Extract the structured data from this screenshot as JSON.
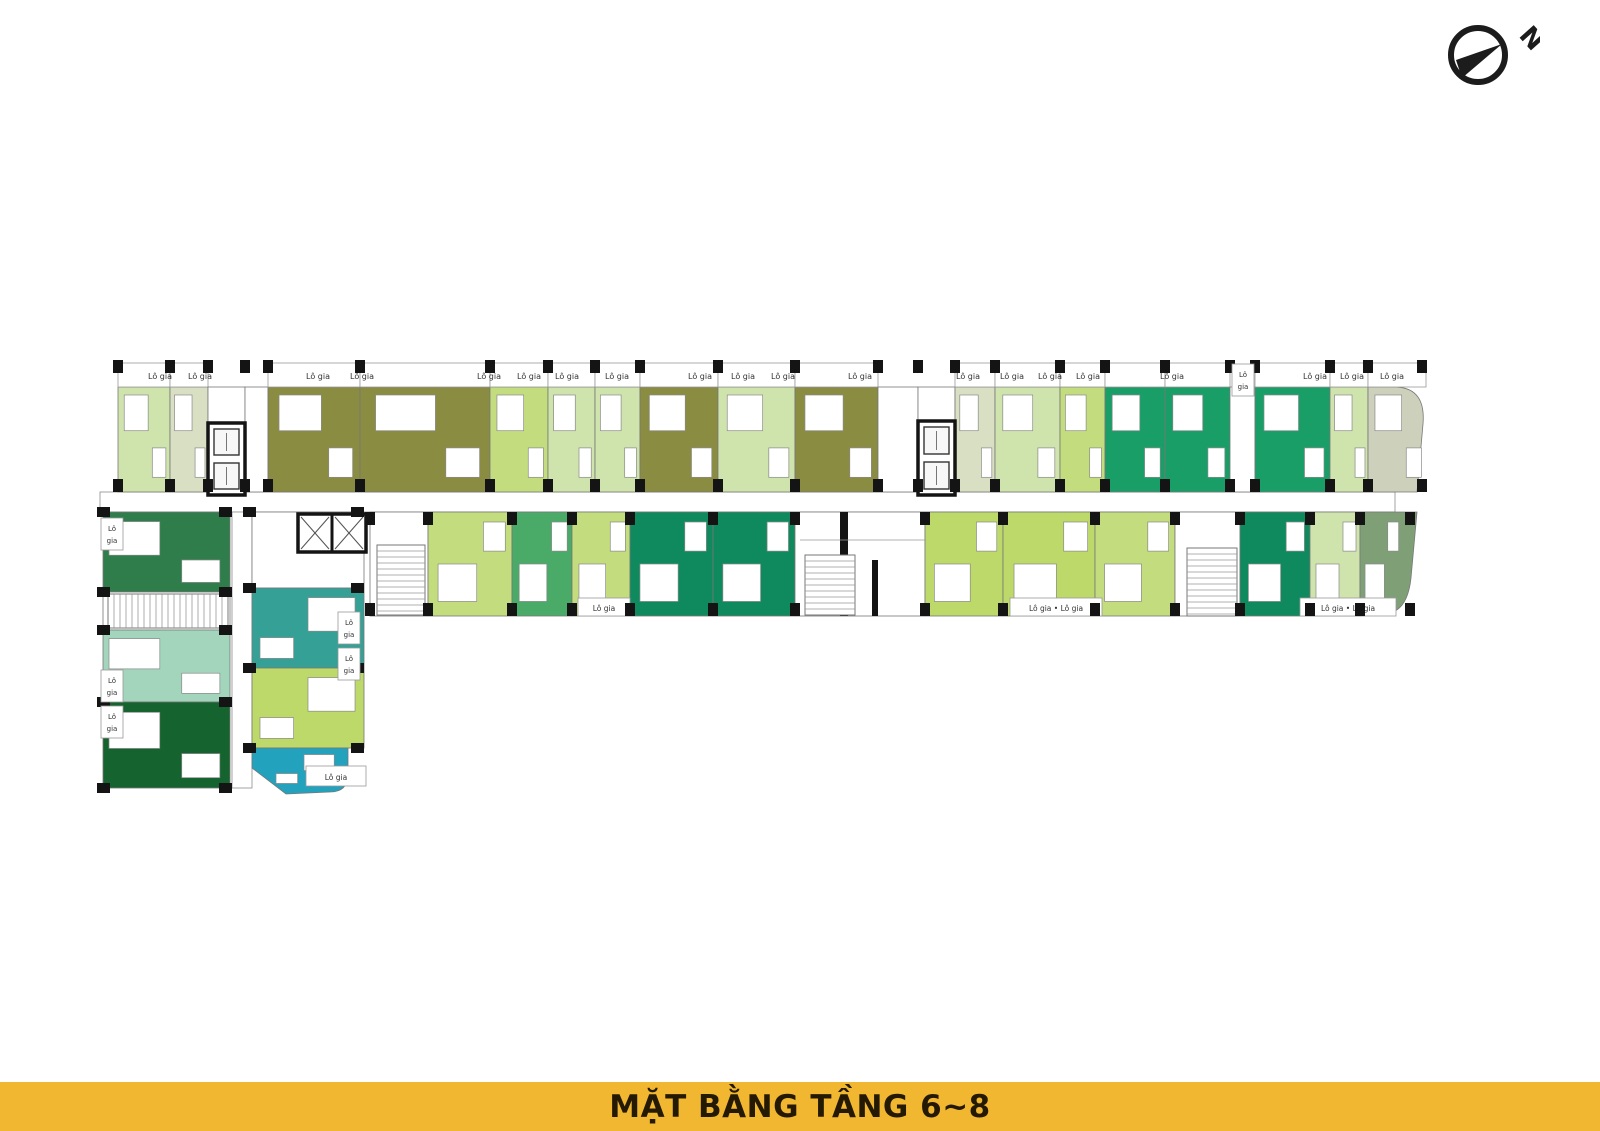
{
  "title_bar": {
    "text": "MẶT BẰNG TẦNG 6~8",
    "bg": "#F2B731",
    "color": "#241A04"
  },
  "north_arrow": {
    "label": "N"
  },
  "plan": {
    "balcony_text": "Lô gia",
    "balcony_text_double": "Lô gia • Lô gia",
    "wall_color": "#141414",
    "line_color": "#8a8a8a",
    "palette": {
      "olive": "#8A8C42",
      "pale": "#CFE3AC",
      "pale2": "#D8DFC2",
      "lime": "#C2DC7E",
      "limeB": "#BCD96A",
      "emerald": "#1A9E68",
      "emeraldD": "#0F8A5F",
      "green": "#4AAA68",
      "forest": "#2E7D4B",
      "forestD": "#15632F",
      "mint": "#A2D5BC",
      "teal": "#35A096",
      "cyan": "#23A2BE",
      "sage": "#CDD0BA",
      "sageG": "#7FA077",
      "white": "#FFFFFF"
    },
    "top_row": {
      "y": 387,
      "h": 105,
      "balcony_y": 363,
      "balcony_h": 24,
      "units": [
        {
          "x": 118,
          "w": 52,
          "c": "pale"
        },
        {
          "x": 170,
          "w": 38,
          "c": "pale2"
        },
        {
          "x": 208,
          "w": 37,
          "c": "white",
          "bal": false
        },
        {
          "x": 245,
          "w": 23,
          "c": "white",
          "bal": false
        },
        {
          "x": 268,
          "w": 92,
          "c": "olive"
        },
        {
          "x": 360,
          "w": 130,
          "c": "olive"
        },
        {
          "x": 490,
          "w": 58,
          "c": "lime"
        },
        {
          "x": 548,
          "w": 47,
          "c": "pale"
        },
        {
          "x": 595,
          "w": 45,
          "c": "pale"
        },
        {
          "x": 640,
          "w": 78,
          "c": "olive"
        },
        {
          "x": 718,
          "w": 77,
          "c": "pale"
        },
        {
          "x": 795,
          "w": 83,
          "c": "olive"
        },
        {
          "x": 878,
          "w": 40,
          "c": "white",
          "bal": false
        },
        {
          "x": 918,
          "w": 37,
          "c": "white",
          "bal": false
        },
        {
          "x": 955,
          "w": 40,
          "c": "pale2"
        },
        {
          "x": 995,
          "w": 65,
          "c": "pale"
        },
        {
          "x": 1060,
          "w": 45,
          "c": "lime"
        },
        {
          "x": 1105,
          "w": 60,
          "c": "emerald"
        },
        {
          "x": 1165,
          "w": 65,
          "c": "emerald"
        },
        {
          "x": 1230,
          "w": 25,
          "c": "white",
          "bal": false
        },
        {
          "x": 1255,
          "w": 75,
          "c": "emerald"
        },
        {
          "x": 1330,
          "w": 38,
          "c": "pale"
        },
        {
          "x": 1368,
          "w": 58,
          "c": "sage",
          "curve": "tr"
        }
      ],
      "labels_x": [
        160,
        200,
        318,
        362,
        489,
        529,
        567,
        617,
        700,
        743,
        783,
        860,
        968,
        1012,
        1050,
        1088,
        1172,
        1315,
        1352,
        1392
      ]
    },
    "bottom_row": {
      "y": 512,
      "h": 104,
      "units": [
        {
          "x": 370,
          "w": 58,
          "c": "white"
        },
        {
          "x": 428,
          "w": 84,
          "c": "lime"
        },
        {
          "x": 512,
          "w": 60,
          "c": "green"
        },
        {
          "x": 572,
          "w": 58,
          "c": "lime"
        },
        {
          "x": 630,
          "w": 83,
          "c": "emeraldD"
        },
        {
          "x": 713,
          "w": 82,
          "c": "emeraldD"
        },
        {
          "x": 795,
          "w": 130,
          "c": "white"
        },
        {
          "x": 925,
          "w": 78,
          "c": "limeB"
        },
        {
          "x": 1003,
          "w": 92,
          "c": "limeB"
        },
        {
          "x": 1095,
          "w": 80,
          "c": "lime"
        },
        {
          "x": 1175,
          "w": 65,
          "c": "white"
        },
        {
          "x": 1240,
          "w": 70,
          "c": "emeraldD"
        },
        {
          "x": 1310,
          "w": 50,
          "c": "pale"
        },
        {
          "x": 1360,
          "w": 42,
          "c": "sageG",
          "curve": "br"
        }
      ],
      "balcony_strips": [
        {
          "x": 578,
          "w": 52,
          "double": false
        },
        {
          "x": 1010,
          "w": 92,
          "double": true
        },
        {
          "x": 1300,
          "w": 96,
          "double": true
        }
      ]
    },
    "wing": {
      "corridor": {
        "x": 232,
        "y": 512,
        "w": 20,
        "h": 276
      },
      "left_col": {
        "x": 103,
        "w": 127,
        "units": [
          {
            "y": 512,
            "h": 80,
            "c": "forest"
          },
          {
            "y": 592,
            "h": 38,
            "c": "white"
          },
          {
            "y": 630,
            "h": 72,
            "c": "mint"
          },
          {
            "y": 702,
            "h": 86,
            "c": "forestD"
          }
        ]
      },
      "right_col": {
        "x": 252,
        "w": 112,
        "units": [
          {
            "y": 512,
            "h": 76,
            "c": "white"
          },
          {
            "y": 588,
            "h": 80,
            "c": "teal"
          },
          {
            "y": 668,
            "h": 80,
            "c": "limeB"
          },
          {
            "y": 748,
            "h": 44,
            "c": "cyan",
            "clip": true
          }
        ]
      },
      "bottom_balcony": {
        "x": 306,
        "y": 766,
        "w": 60,
        "h": 20
      }
    },
    "side_labels": [
      {
        "x": 101,
        "y": 518
      },
      {
        "x": 101,
        "y": 670
      },
      {
        "x": 101,
        "y": 706
      },
      {
        "x": 338,
        "y": 612
      },
      {
        "x": 338,
        "y": 648
      },
      {
        "x": 1232,
        "y": 364
      }
    ],
    "cores": [
      {
        "x": 208,
        "y": 423,
        "w": 37,
        "h": 72,
        "type": "lift"
      },
      {
        "x": 918,
        "y": 421,
        "w": 37,
        "h": 74,
        "type": "lift"
      },
      {
        "x": 298,
        "y": 514,
        "w": 68,
        "h": 38,
        "type": "x"
      }
    ],
    "stairs": [
      {
        "x": 377,
        "y": 545,
        "w": 48,
        "h": 70,
        "dir": "h"
      },
      {
        "x": 805,
        "y": 555,
        "w": 50,
        "h": 60,
        "dir": "h"
      },
      {
        "x": 1187,
        "y": 548,
        "w": 50,
        "h": 68,
        "dir": "h"
      },
      {
        "x": 108,
        "y": 594,
        "w": 120,
        "h": 34,
        "dir": "v"
      }
    ],
    "corridor": {
      "x": 100,
      "y": 492,
      "w": 1295,
      "h": 20
    }
  }
}
